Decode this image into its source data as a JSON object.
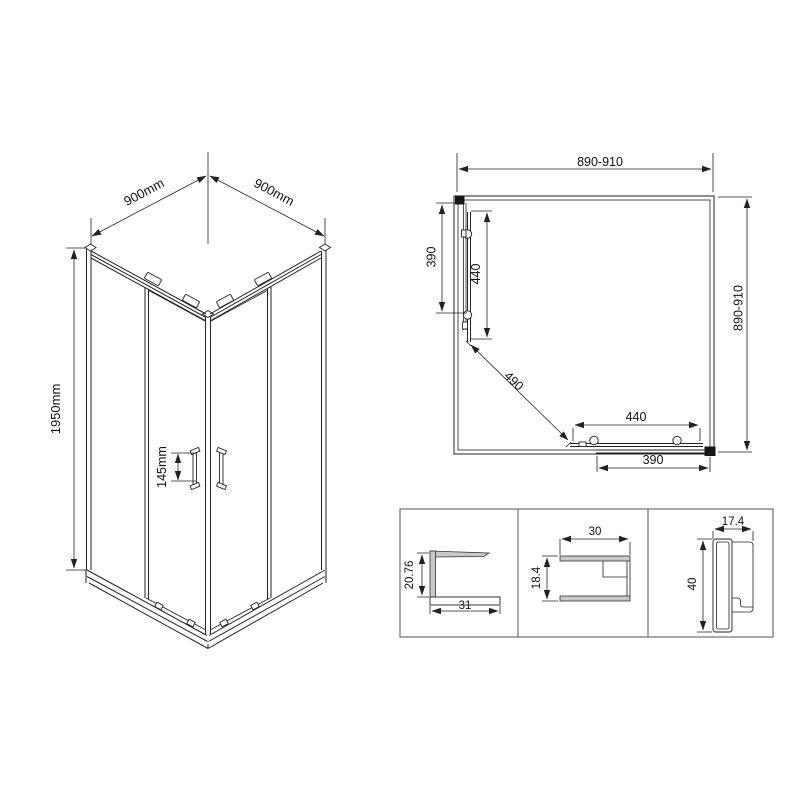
{
  "iso": {
    "width_left": "900mm",
    "width_right": "900mm",
    "height": "1950mm",
    "handle_spacing": "145mm"
  },
  "plan": {
    "width_top": "890-910",
    "depth_right": "890-910",
    "fixed_left": "390",
    "door_left": "440",
    "opening_diagonal": "490",
    "door_bottom": "440",
    "fixed_bottom": "390"
  },
  "profiles": {
    "c_height": "20.76",
    "c_width": "31",
    "u_width": "30",
    "u_height": "18.4",
    "wall_width": "17.4",
    "wall_height": "40"
  },
  "colors": {
    "line": "#222222",
    "aluminium_fill": "#c9c9c9",
    "background": "#ffffff"
  }
}
